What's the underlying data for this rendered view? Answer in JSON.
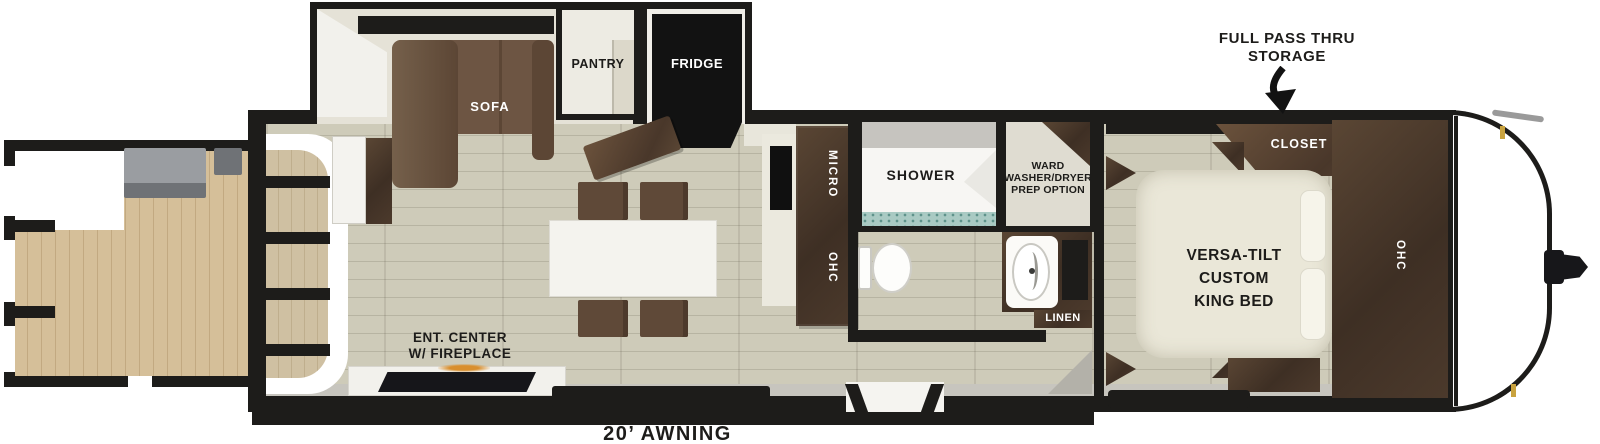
{
  "annotations": {
    "pass_thru": {
      "line1": "FULL PASS THRU",
      "line2": "STORAGE"
    },
    "awning": "20’ AWNING"
  },
  "living": {
    "sofa": "SOFA",
    "pantry": "PANTRY",
    "fridge": "FRIDGE",
    "micro": "MICRO",
    "ohc": "OHC",
    "ent_center": {
      "line1": "ENT. CENTER",
      "line2": "W/ FIREPLACE"
    }
  },
  "bath": {
    "shower": "SHOWER",
    "ward": {
      "line1": "WARD",
      "line2": "WASHER/DRYER",
      "line3": "PREP OPTION"
    },
    "linen": "LINEN"
  },
  "bedroom": {
    "closet": "CLOSET",
    "bed": {
      "line1": "VERSA-TILT",
      "line2": "CUSTOM",
      "line3": "KING BED"
    },
    "ohc": "OHC"
  },
  "colors": {
    "wall": "#1d1c1a",
    "floor": "#cecbb9",
    "floor_seam": "#b7b4a2",
    "deck_wood": "#d5bf99",
    "deck_seam": "#c2a981",
    "sofa_brown": "#6d5543",
    "chair_brown": "#5f4938",
    "bed_cream": "#eae7d8",
    "slide_wall": "#e5e2d7",
    "sill_gray": "#c7c5be",
    "tile": "#a9cac3",
    "flame": "#d98f2e",
    "gold": "#c9a33f"
  }
}
